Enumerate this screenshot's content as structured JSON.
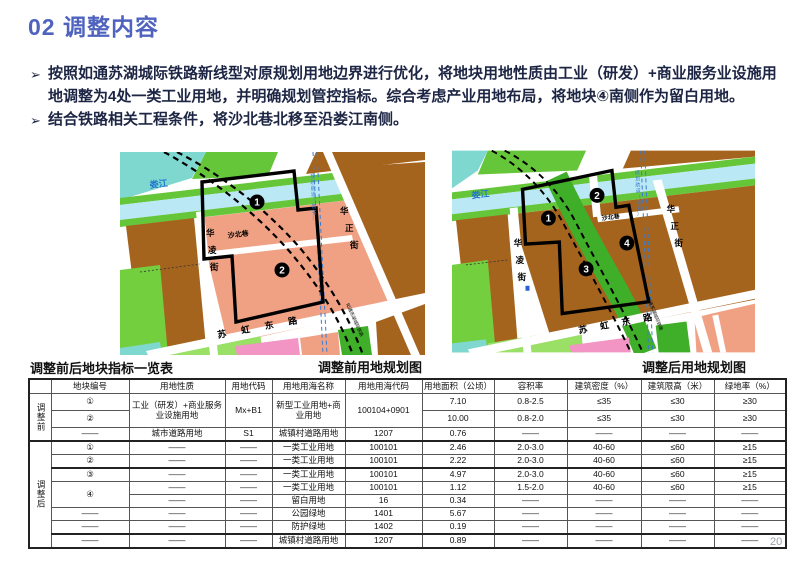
{
  "slide": {
    "title": "02 调整内容",
    "bullet_marker": "➢",
    "bullets": [
      "按照如通苏湖城际铁路新线型对原规划用地边界进行优化，将地块用地性质由工业（研发）+商业服务业设施用地调整为4处一类工业用地，并明确规划管控指标。综合考虑产业用地布局，将地块④南侧作为留白用地。",
      "结合铁路相关工程条件，将沙北巷北移至沿娄江南侧。"
    ],
    "page_number": "20"
  },
  "captions": {
    "table": "调整前后地块指标一览表",
    "map_before": "调整前用地规划图",
    "map_after": "调整后用地规划图"
  },
  "maps": {
    "before": {
      "river": "娄江",
      "road_shabei": "沙北巷",
      "road_hualing": "华凌街",
      "road_huazheng": "华正街",
      "road_suhong": "苏虹东路",
      "rail_note": "如通苏湖城际铁路",
      "blue_note": "规划航道（暂名）",
      "plots": [
        "1",
        "2"
      ]
    },
    "after": {
      "river": "娄江",
      "road_shabei": "沙北巷",
      "road_hualing": "华凌街",
      "road_huazheng": "华正街",
      "road_suhong": "苏虹东路",
      "rail_note": "如通苏湖城际铁路",
      "blue_note": "规划航道（暂名）",
      "plots": [
        "1",
        "2",
        "3",
        "4"
      ]
    }
  },
  "table": {
    "group_before": "调整前",
    "group_after": "调整后",
    "headers": [
      "地块编号",
      "用地性质",
      "用地代码",
      "用地用海名称",
      "用地用海代码",
      "用地面积（公顷）",
      "容积率",
      "建筑密度（%）",
      "建筑限高（米）",
      "绿地率（%）"
    ],
    "rows_before": [
      [
        "①",
        "工业（研发）+商业服务业设施用地",
        "Mx+B1",
        "新型工业用地+商业用地",
        "100104+0901",
        "7.10",
        "0.8-2.5",
        "≤35",
        "≤30",
        "≥30"
      ],
      [
        "②",
        "10.00",
        "0.8-2.0",
        "≤35",
        "≤30",
        "≥30"
      ],
      [
        "——",
        "城市道路用地",
        "S1",
        "城镇村道路用地",
        "1207",
        "0.76",
        "——",
        "——",
        "——",
        "——"
      ]
    ],
    "rows_after": [
      [
        "①",
        "——",
        "——",
        "一类工业用地",
        "100101",
        "2.46",
        "2.0-3.0",
        "40-60",
        "≤60",
        "≥15"
      ],
      [
        "②",
        "——",
        "——",
        "一类工业用地",
        "100101",
        "2.22",
        "2.0-3.0",
        "40-60",
        "≤60",
        "≥15"
      ],
      [
        "③",
        "——",
        "——",
        "一类工业用地",
        "100101",
        "4.97",
        "2.0-3.0",
        "40-60",
        "≤60",
        "≥15"
      ],
      [
        "④",
        "——",
        "——",
        "一类工业用地",
        "100101",
        "1.12",
        "1.5-2.0",
        "40-60",
        "≤60",
        "≥15"
      ],
      [
        "——",
        "——",
        "留白用地",
        "16",
        "0.34",
        "——",
        "——",
        "——",
        "——"
      ],
      [
        "——",
        "——",
        "——",
        "公园绿地",
        "1401",
        "5.67",
        "——",
        "——",
        "——",
        "——"
      ],
      [
        "——",
        "——",
        "——",
        "防护绿地",
        "1402",
        "0.19",
        "——",
        "——",
        "——",
        "——"
      ],
      [
        "——",
        "——",
        "——",
        "城镇村道路用地",
        "1207",
        "0.89",
        "——",
        "——",
        "——",
        "——"
      ]
    ]
  },
  "colors": {
    "title_blue": "#4f63be",
    "body_text": "#1d2544",
    "parcel_brown": "#a5641e",
    "parcel_salmon": "#f0a183",
    "green_bright": "#66c63a",
    "green_mid": "#3fae28",
    "river_blue": "#bae8f5",
    "cyan": "#7ed8d0",
    "pink": "#f295c5",
    "blue_line": "#3a7cd0",
    "boundary_black": "#000000"
  }
}
